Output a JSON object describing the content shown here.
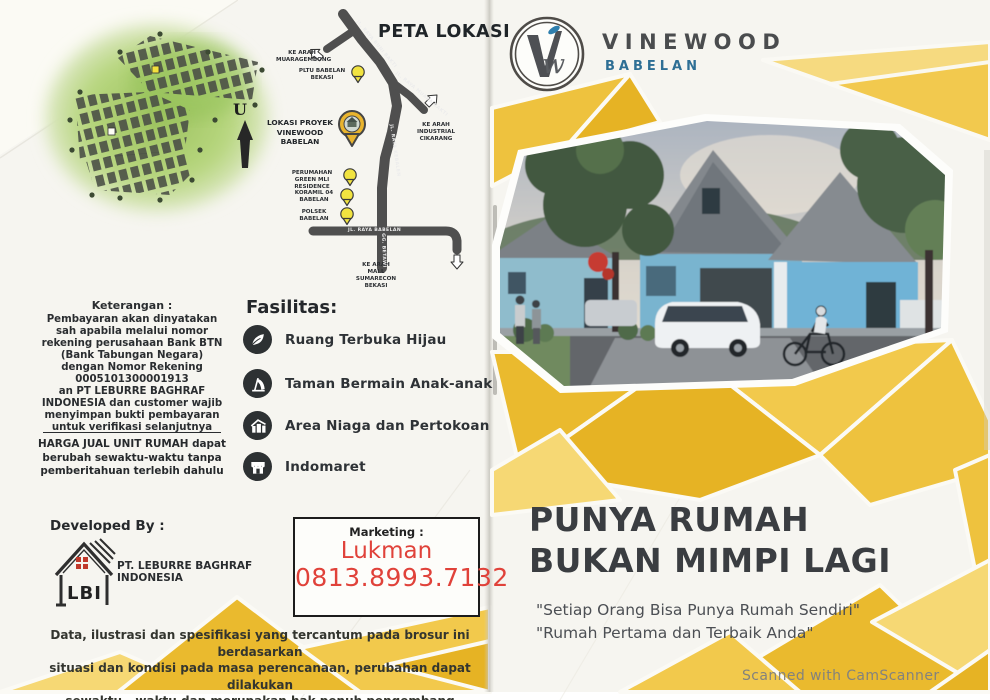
{
  "colors": {
    "gold": "#eaba2e",
    "gold_light": "#f2c94c",
    "gold_pale": "#f6d874",
    "brand_blue": "#2e6f95",
    "marketing_red": "#e0423a",
    "headline_dark": "#3a3d41"
  },
  "site_plan": {
    "north_label": "U"
  },
  "location_map": {
    "title": "PETA LOKASI",
    "project_marker_label": "LOKASI PROYEK\nVINEWOOD BABELAN",
    "markers": [
      {
        "label": "PLTU BABELAN\nBEKASI"
      },
      {
        "label": "PERUMAHAN\nGREEN MLI RESIDENCE"
      },
      {
        "label": "KORAMIL 04\nBABELAN"
      },
      {
        "label": "POLSEK\nBABELAN"
      }
    ],
    "direction_arrows": [
      {
        "label": "KE ARAH\nMUARAGEMBONG"
      },
      {
        "label": "KE ARAH\nINDUSTRIAL\nCIKARANG"
      },
      {
        "label": "KE ARAH\nMALL SUMARECON\nBEKASI"
      }
    ],
    "roads": [
      {
        "label": "JL. RAYA BUNI BAKTI"
      },
      {
        "label": "JL. RAYA MUARA BAKTI"
      },
      {
        "label": "JL. RAYA KEBALEN"
      },
      {
        "label": "JL. RAYA BABELAN"
      },
      {
        "label": "GG. BETAWI"
      }
    ]
  },
  "keterangan": {
    "title": "Keterangan :",
    "body": "Pembayaran akan dinyatakan\nsah apabila melalui nomor\nrekening perusahaan Bank BTN\n(Bank Tabungan Negara)\ndengan Nomor Rekening\n0005101300001913\nan PT LEBURRE BAGHRAF\nINDONESIA dan customer wajib\nmenyimpan bukti pembayaran\nuntuk verifikasi selanjutnya",
    "price_note": "HARGA JUAL UNIT RUMAH dapat\nberubah sewaktu-waktu tanpa\npemberitahuan terlebih dahulu"
  },
  "fasilitas": {
    "title": "Fasilitas:",
    "items": [
      {
        "icon": "leaf-icon",
        "label": "Ruang Terbuka Hijau"
      },
      {
        "icon": "playground-icon",
        "label": "Taman Bermain Anak-anak"
      },
      {
        "icon": "commerce-icon",
        "label": "Area Niaga dan Pertokoan"
      },
      {
        "icon": "storefront-icon",
        "label": "Indomaret"
      }
    ]
  },
  "developer": {
    "title": "Developed By :",
    "logo_text": "LBI",
    "company": "PT. LEBURRE BAGHRAF INDONESIA"
  },
  "marketing": {
    "label": "Marketing :",
    "name": "Lukman",
    "phone": "0813.8993.7132"
  },
  "disclaimer": "Data, ilustrasi dan spesifikasi yang tercantum pada brosur ini berdasarkan\nsituasi dan kondisi pada masa perencanaan, perubahan dapat dilakukan\nsewaktu - waktu dan merupakan hak penuh pengembang",
  "brand": {
    "monogram_v": "V",
    "monogram_w": "w",
    "name": "VINEWOOD",
    "location": "BABELAN"
  },
  "hero": {
    "headline": "PUNYA RUMAH\nBUKAN MIMPI LAGI",
    "quotes": "\"Setiap Orang Bisa Punya Rumah Sendiri\"\n\"Rumah Pertama dan Terbaik Anda\""
  },
  "footer": {
    "scanner_watermark": "Scanned with CamScanner"
  }
}
